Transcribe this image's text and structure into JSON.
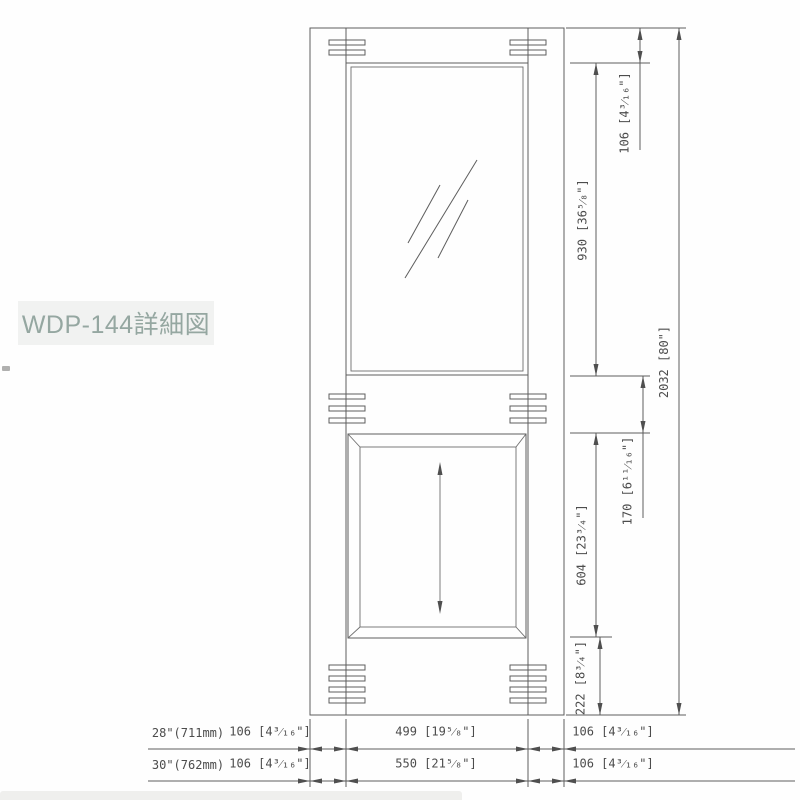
{
  "title": "WDP-144詳細図",
  "drawing": {
    "right_dims": {
      "top_rail": "106 [4³⁄₁₆\"]",
      "glass_opening": "930 [36⁵⁄₈\"]",
      "mid_rail": "170 [6¹¹⁄₁₆\"]",
      "panel_opening": "604 [23³⁄₄\"]",
      "bottom_rail": "222 [8³⁄₄\"]",
      "overall_height": "2032 [80\"]"
    },
    "width_table": {
      "rows": [
        {
          "door_size": "28\"(711mm)",
          "left_stile": "106 [4³⁄₁₆\"]",
          "center_width": "499 [19⁵⁄₈\"]",
          "right_stile": "106 [4³⁄₁₆\"]"
        },
        {
          "door_size": "30\"(762mm)",
          "left_stile": "106 [4³⁄₁₆\"]",
          "center_width": "550 [21⁵⁄₈\"]",
          "right_stile": "106 [4³⁄₁₆\"]"
        }
      ]
    }
  },
  "colors": {
    "label_text": "#95a7a1",
    "label_bg": "#f1f2f1",
    "line": "#5d5d5d",
    "dim_text": "#4c4c4c"
  }
}
